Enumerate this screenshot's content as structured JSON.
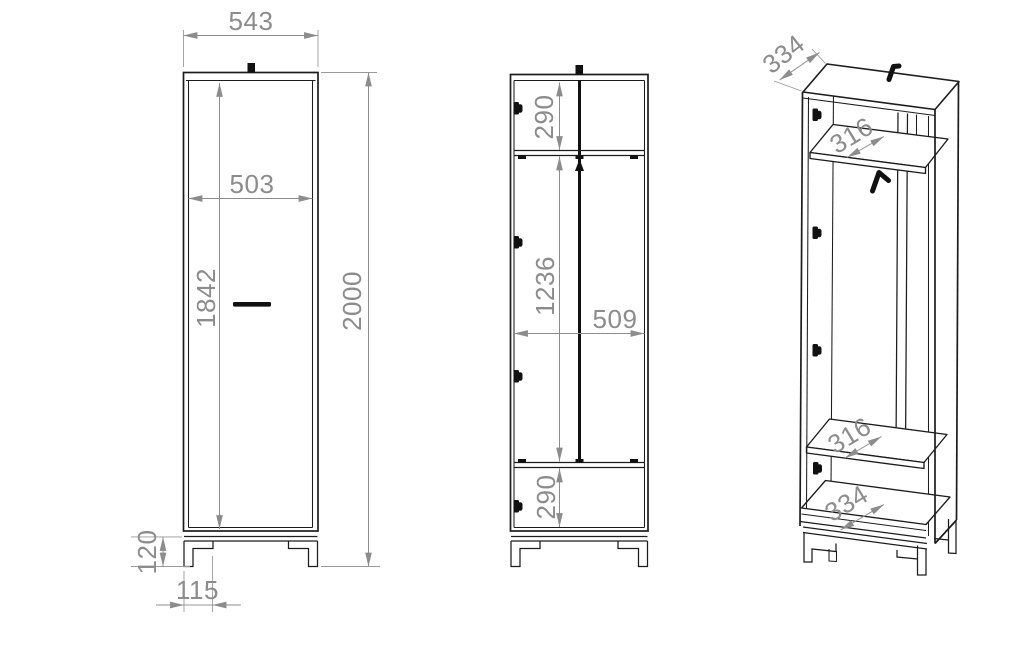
{
  "drawing_type": "furniture-dimension-drawing",
  "colors": {
    "line": "#1c1c1c",
    "dimension": "#8c8c8c",
    "hardware": "#111111",
    "background": "#ffffff"
  },
  "views": {
    "front": {
      "overall_width": "543",
      "door_width": "503",
      "door_height": "1842",
      "overall_height": "2000",
      "leg_height": "120",
      "leg_inset": "115"
    },
    "section": {
      "top_compartment": "290",
      "middle_compartment": "1236",
      "interior_width": "509",
      "bottom_compartment": "290"
    },
    "perspective": {
      "top_depth": "334",
      "upper_shelf_depth": "316",
      "lower_shelf_depth": "316",
      "bottom_depth": "334"
    }
  },
  "hardware_icons": [
    "top-mount-bracket",
    "door-handle",
    "hinge",
    "coat-hook"
  ]
}
